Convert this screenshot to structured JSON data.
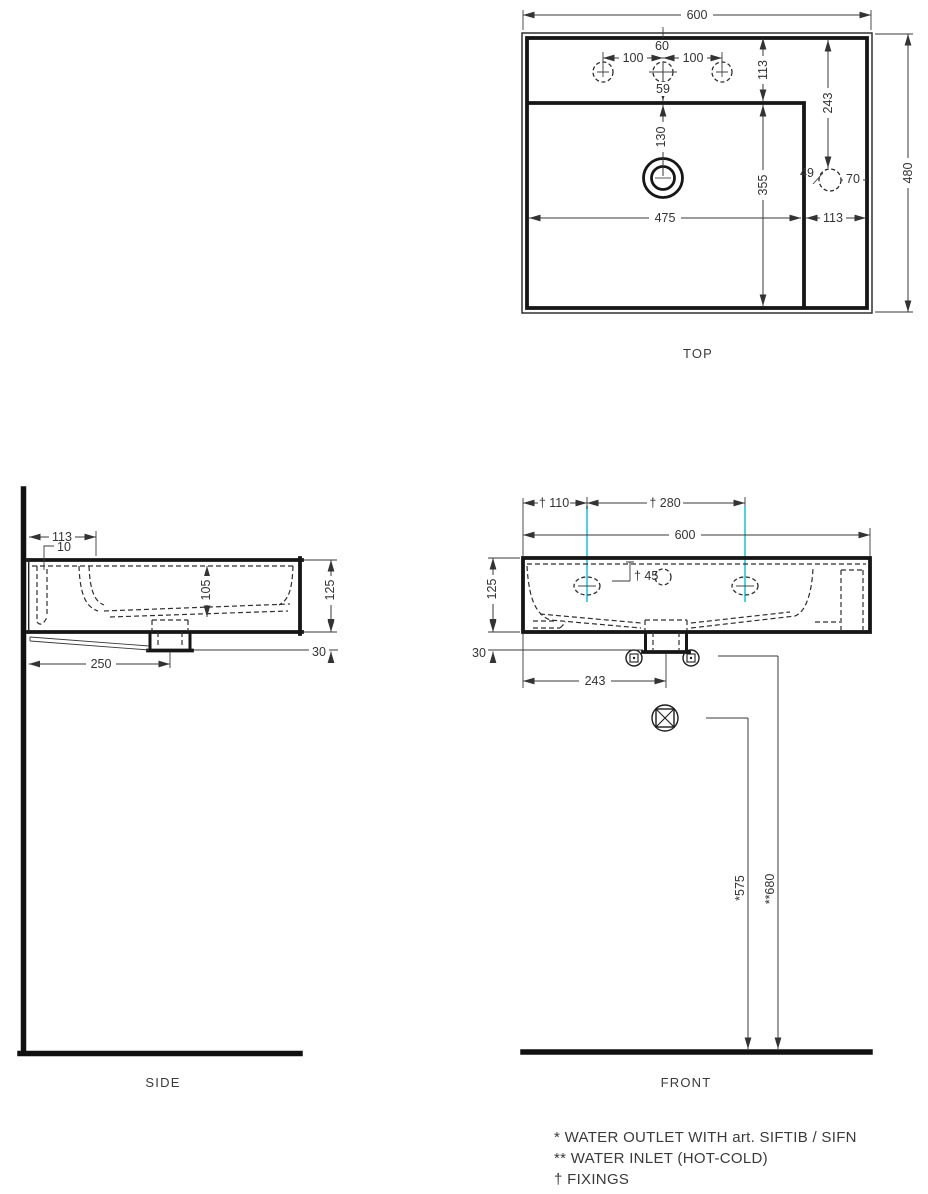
{
  "colors": {
    "line": "#161616",
    "fixing_line": "#4cd3e0",
    "text": "#3a3a3a"
  },
  "views": {
    "top": {
      "label": "TOP"
    },
    "side": {
      "label": "SIDE"
    },
    "front": {
      "label": "FRONT"
    }
  },
  "top_dims": {
    "width": "600",
    "height": "480",
    "hole_pitch_left": "100",
    "hole_pitch_right": "100",
    "center_hole": "60",
    "hole_to_bowl": "59",
    "rim_depth": "113",
    "bowl_length": "355",
    "drain_offset": "130",
    "overflow_offset": "243",
    "bowl_width": "475",
    "rim_right": "113",
    "overflow_dia": "49",
    "overflow_edge": "70"
  },
  "side_dims": {
    "rim_back": "113",
    "channel_gap": "10",
    "bowl_depth": "105",
    "body_height": "125",
    "trap_drop": "30",
    "trap_center": "250"
  },
  "front_dims": {
    "fixing_left": "† 110",
    "fixing_pitch": "† 280",
    "width": "600",
    "fixing_drop": "† 45",
    "body_height": "125",
    "trap_drop": "30",
    "trap_center": "243",
    "outlet_height": "*575",
    "inlet_height": "**680"
  },
  "legend": {
    "lines": [
      "*  WATER OUTLET WITH art. SIFTIB / SIFN",
      "** WATER INLET (HOT-COLD)",
      "† FIXINGS"
    ]
  }
}
